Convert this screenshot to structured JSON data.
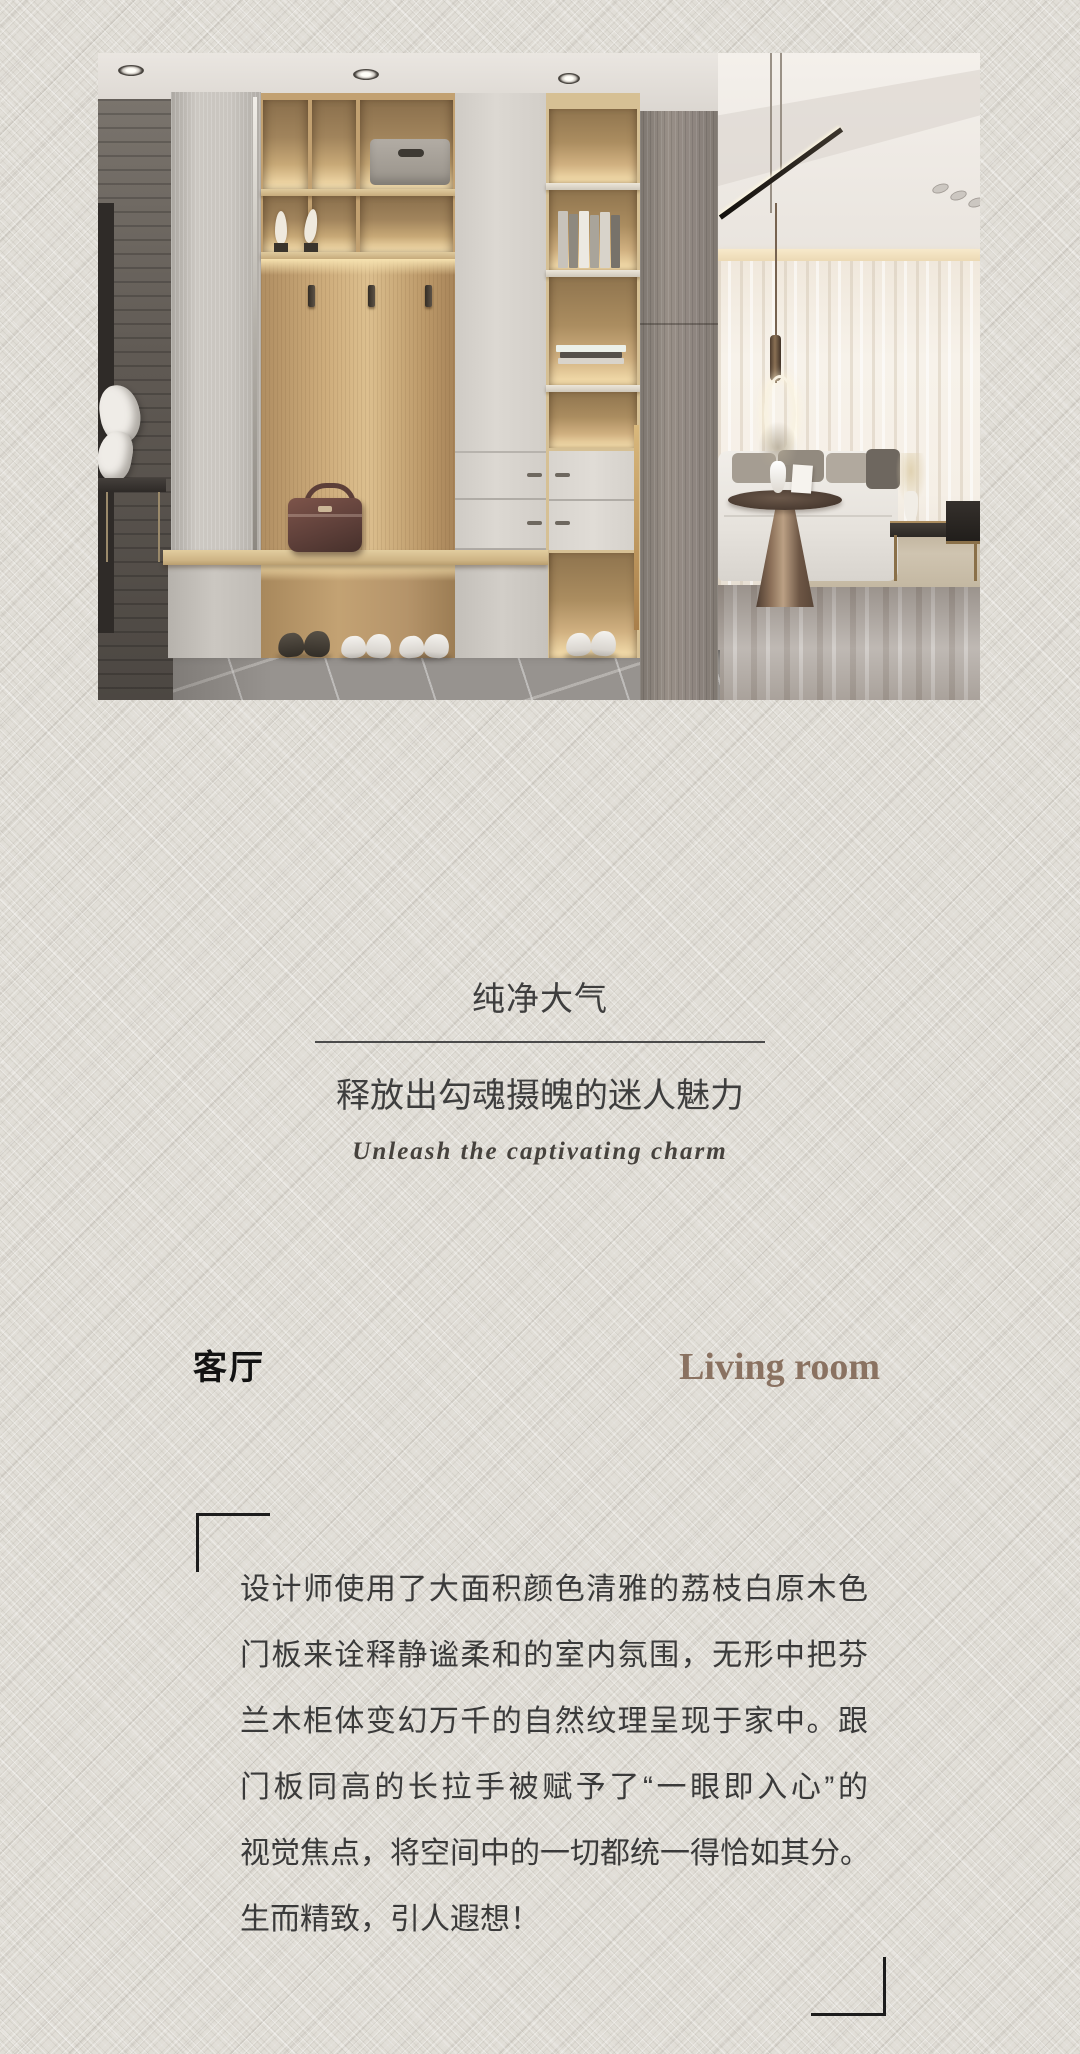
{
  "page": {
    "width": 1080,
    "height": 2054,
    "background": "#e1ded7"
  },
  "hero": {
    "name": "entryway-cabinet-and-living-room-rendering"
  },
  "headline": {
    "title": "纯净大气",
    "subtitle": "释放出勾魂摄魄的迷人魅力",
    "tagline_en": "Unleash the captivating charm"
  },
  "room": {
    "name_cn": "客厅",
    "name_en": "Living room",
    "en_color": "#8a7261"
  },
  "article": {
    "lines": [
      "设计师使用了大面积颜色清雅的荔枝白原木色",
      "门板来诠释静谧柔和的室内氛围，无形中把芬",
      "兰木柜体变幻万千的自然纹理呈现于家中。跟",
      "门板同高的长拉手被赋予了“一眼即入心”的",
      "视觉焦点，将空间中的一切都统一得恰如其分。",
      "生而精致，引人遐想！"
    ]
  }
}
